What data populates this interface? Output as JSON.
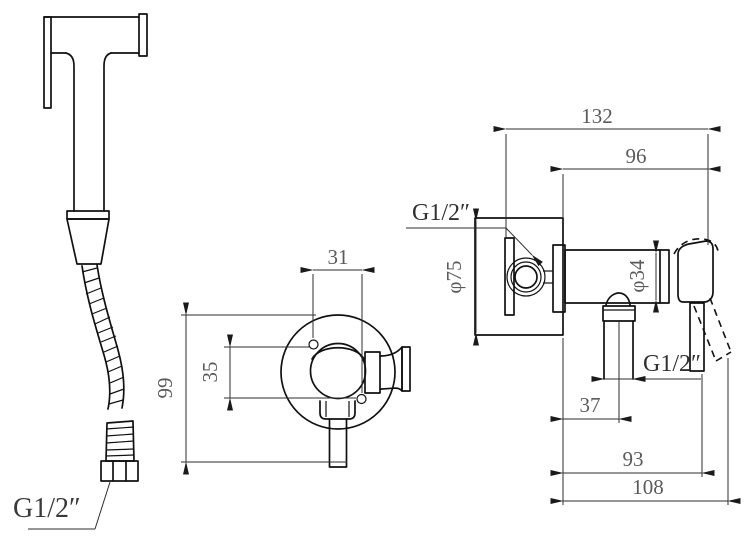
{
  "drawing": {
    "type": "technical-drawing",
    "background": "#ffffff",
    "colors": {
      "line": "#111111",
      "dimension_text": "#5a5a5a",
      "label_text": "#303030"
    },
    "views": {
      "sprayer": {
        "name": "hand-sprayer-with-hose",
        "hose_thread_label": "G1/2″"
      },
      "front": {
        "name": "valve-front-view",
        "dims": {
          "hole_spacing_horizontal": "31",
          "hole_spacing_vertical": "35",
          "overall_height": "99"
        }
      },
      "side": {
        "name": "valve-side-view",
        "dims": {
          "total_depth": "132",
          "front_projection": "96",
          "plate_diameter": "φ75",
          "body_diameter": "φ34",
          "outlet_offset": "37",
          "handle_reach": "93",
          "overall_reach": "108"
        },
        "inlet_thread_label": "G1/2″",
        "outlet_thread_label": "G1/2″"
      }
    }
  }
}
